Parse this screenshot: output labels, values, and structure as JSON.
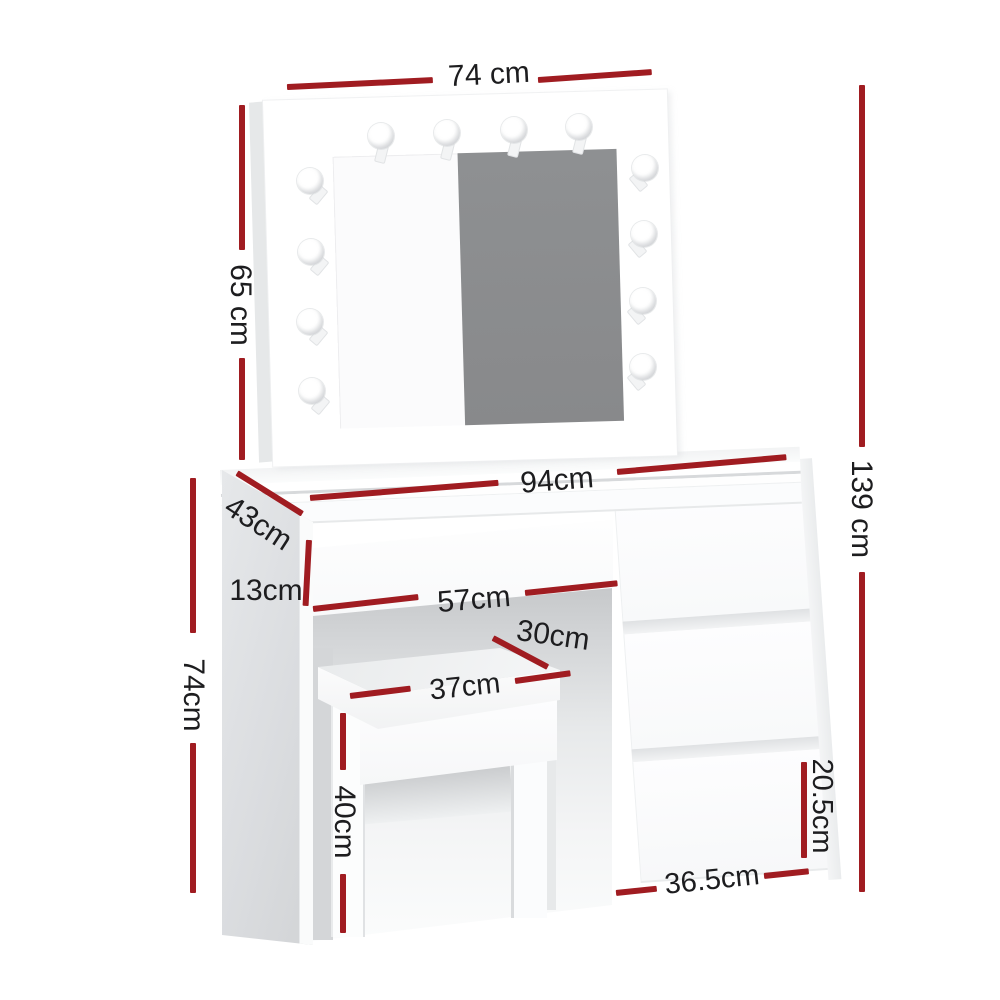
{
  "diagram_type": "furniture-dimension-diagram",
  "colors": {
    "dimension_line": "#a01c21",
    "dimension_text": "#1d1d1f",
    "mirror_glass": "#8b8d8e",
    "furniture_shade": "#d8dadc",
    "background": "#ffffff"
  },
  "dims": {
    "mirror_width": {
      "label": "74 cm"
    },
    "mirror_height": {
      "label": "65 cm"
    },
    "total_height": {
      "label": "139 cm"
    },
    "desktop_width": {
      "label": "94cm"
    },
    "desktop_depth": {
      "label": "43cm"
    },
    "middle_drawer_height": {
      "label": "13cm"
    },
    "knee_space_width": {
      "label": "57cm"
    },
    "stool_depth": {
      "label": "30cm"
    },
    "stool_width": {
      "label": "37cm"
    },
    "stool_height": {
      "label": "40cm"
    },
    "desk_height": {
      "label": "74cm"
    },
    "drawer_height": {
      "label": "20.5cm"
    },
    "drawer_unit_width": {
      "label": "36.5cm"
    }
  }
}
